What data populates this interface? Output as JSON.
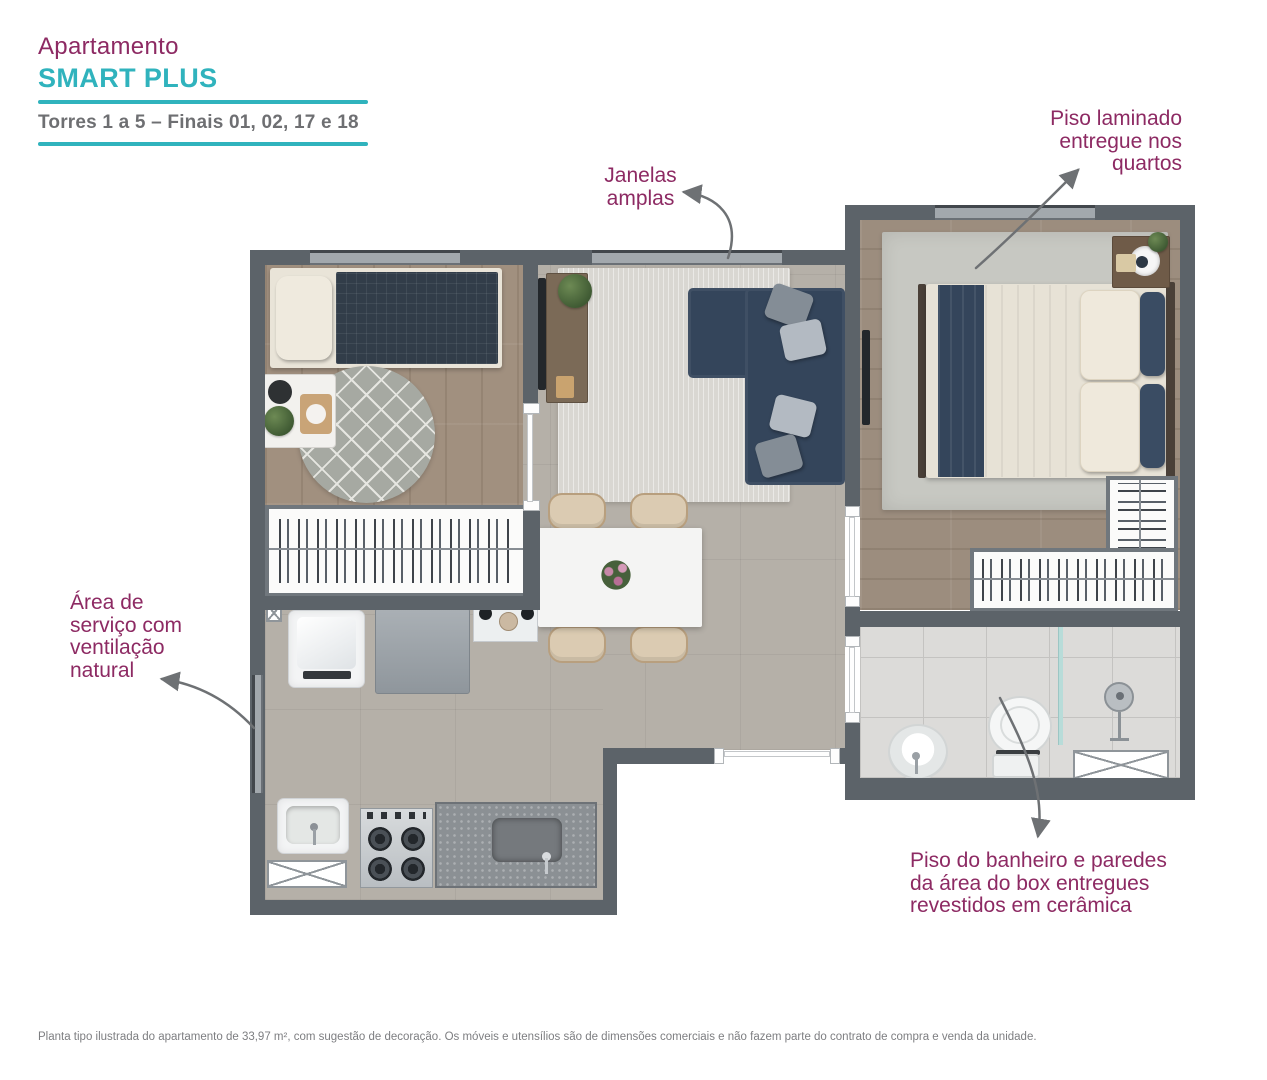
{
  "header": {
    "title": "Apartamento",
    "brand": "SMART PLUS",
    "subtitle": "Torres 1 a 5 – Finais 01, 02, 17 e 18"
  },
  "annotations": {
    "windows": "Janelas\namplas",
    "laminate_floor": "Piso laminado\nentregue nos\nquartos",
    "service_area": "Área de\nserviço com\nventilação\nnatural",
    "bathroom_floor": "Piso do banheiro e paredes\nda área do box entregues\nrevestidos em cerâmica"
  },
  "disclaimer": "Planta tipo ilustrada do apartamento de 33,97 m², com sugestão de decoração. Os móveis e utensílios são de dimensões comerciais e não fazem parte do contrato de compra e venda da unidade.",
  "colors": {
    "accent_teal": "#30b3bd",
    "accent_magenta": "#8d2a63",
    "subtitle_gray": "#6e6f72",
    "wall_gray": "#5c6369"
  }
}
